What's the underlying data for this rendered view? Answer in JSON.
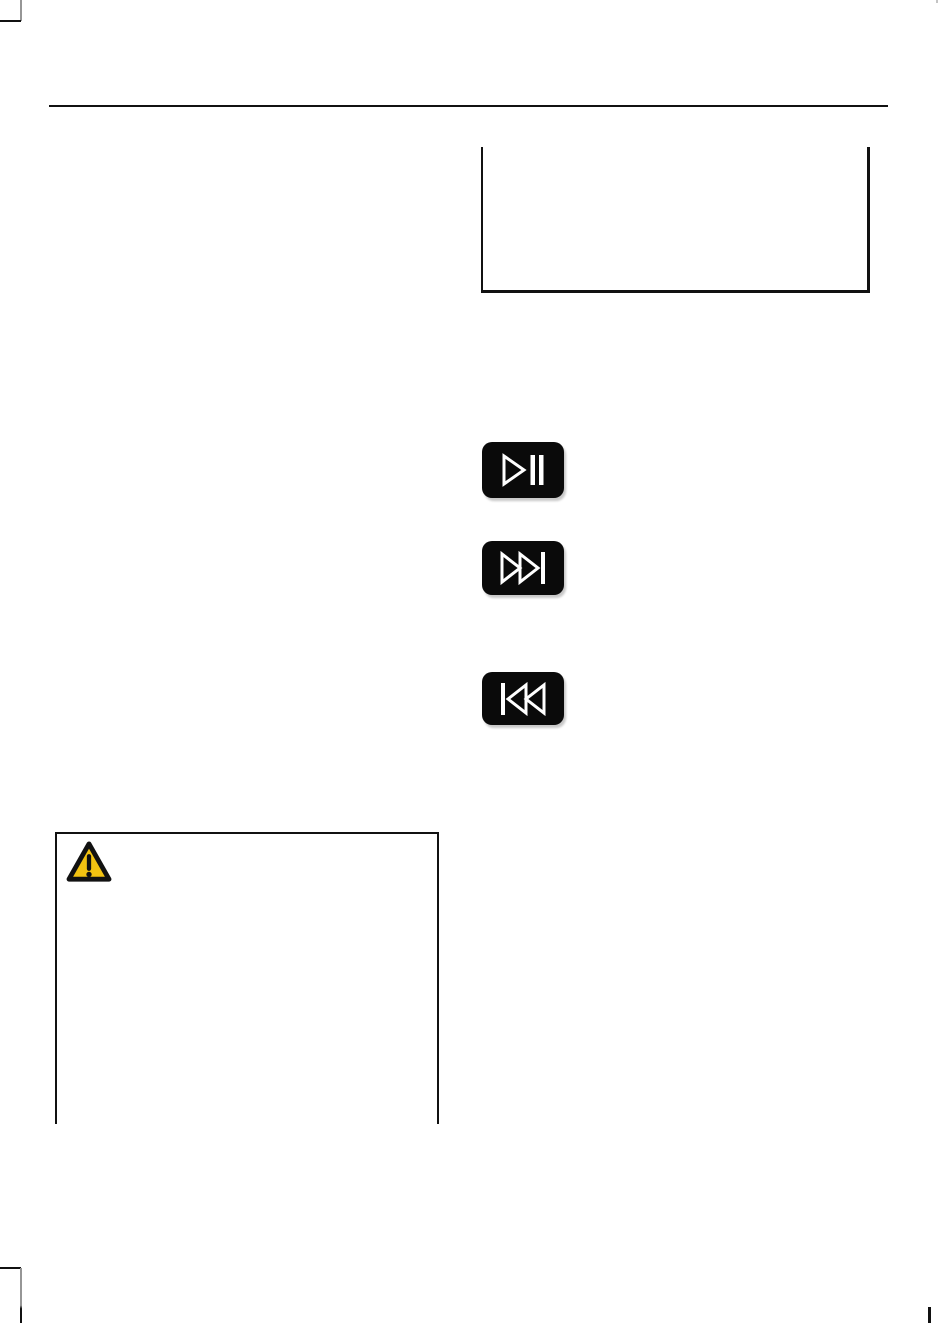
{
  "page": {
    "kind": "manual-page",
    "visible_text": ""
  },
  "colors": {
    "page-bg": "#ffffff",
    "line": "#111111",
    "crop-gray": "#969696",
    "button-bg": "#0a0a0a",
    "icon-stroke": "#ffffff",
    "warning-yellow": "#f2c211",
    "warning-border": "#111111"
  },
  "figure_box": {
    "style": "open-top rectangle, right column, empty"
  },
  "media_buttons": [
    {
      "id": "play-pause",
      "icon": "play-pause-icon"
    },
    {
      "id": "seek-forward",
      "icon": "next-track-icon"
    },
    {
      "id": "seek-backward",
      "icon": "previous-track-icon"
    }
  ],
  "warning_box": {
    "style": "open-bottom rectangle, left column, empty",
    "icon": "warning-triangle-icon"
  },
  "crop_marks": [
    "top-left-corner-mark",
    "top-right-tick",
    "bottom-left-corner-mark",
    "bottom-right-tick"
  ]
}
